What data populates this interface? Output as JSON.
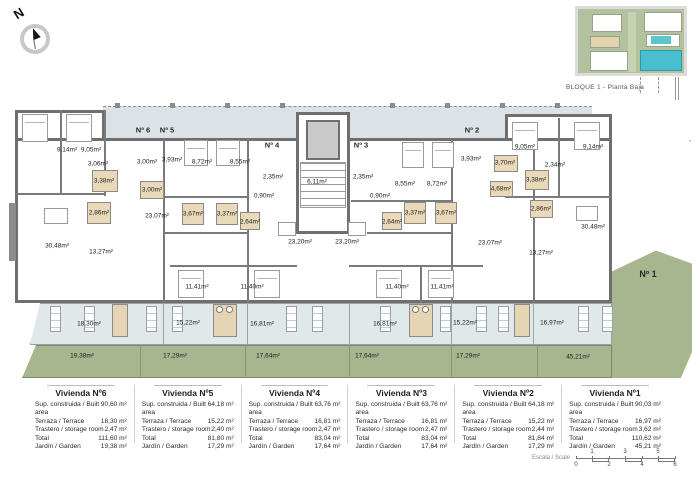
{
  "header": {
    "bloque_label": "BLOQUE 1 - Planta Baja"
  },
  "compass": {
    "letter": "N"
  },
  "plan": {
    "colors": {
      "wall": "#6f6f6f",
      "deck": "#dbe3e6",
      "terrace": "#e0e8ea",
      "garden": "#a8b690",
      "bathroom": "#ead9b8",
      "highlight_teal": "#49bece"
    },
    "entrances": {
      "n6": "Nº 6",
      "n5": "Nº 5",
      "n4": "Nº 4",
      "n3": "Nº 3",
      "n2": "Nº 2",
      "n1": "Nº 1"
    },
    "rooms": {
      "a1": "9,14m²",
      "a2": "9,05m²",
      "a3": "3,06m²",
      "a4": "3,38m²",
      "a5": "2,86m²",
      "a6": "30,48m²",
      "a7": "13,27m²",
      "b1": "3,00m²",
      "b2": "3,93m²",
      "b3": "3,00m²",
      "b4": "8,72m²",
      "b5": "8,55m²",
      "b6": "23,07m²",
      "b7": "3,67m²",
      "b8": "3,37m²",
      "b9": "11,41m²",
      "c1": "2,35m²",
      "c2": "0,90m²",
      "c3": "2,64m²",
      "c4": "23,20m²",
      "c5": "11,40m²",
      "c6": "6,11m²",
      "d1": "2,35m²",
      "d2": "0,90m²",
      "d3": "2,64m²",
      "d4": "23,20m²",
      "d5": "8,55m²",
      "d6": "8,72m²",
      "d7": "3,37m²",
      "d8": "3,67m²",
      "d9": "11,40m²",
      "e1": "3,93m²",
      "e2": "3,70m²",
      "e3": "9,05m²",
      "e4": "2,34m²",
      "e5": "3,38m²",
      "e6": "4,68m²",
      "e7": "2,86m²",
      "e8": "11,41m²",
      "e9": "23,07m²",
      "e10": "13,27m²",
      "f1": "9,14m²",
      "f2": "30,48m²",
      "t1": "18,30m²",
      "t2": "15,22m²",
      "t3": "16,81m²",
      "t4": "16,81m²",
      "t5": "15,22m²",
      "t6": "16,97m²",
      "g1": "19,38m²",
      "g2": "17,29m²",
      "g3": "17,64m²",
      "g4": "17,64m²",
      "g5": "17,29m²",
      "g6": "45,21m²"
    }
  },
  "legend_tables": {
    "row_labels": [
      "Sup. construida / Built area",
      "Terraza / Terrace",
      "Trastero / storage room",
      "Total",
      "Jardín / Garden"
    ],
    "units": [
      {
        "title": "Vivienda Nº6",
        "values": [
          "90,60 m²",
          "18,30 m²",
          "2,47 m²",
          "111,60 m²",
          "19,38 m²"
        ]
      },
      {
        "title": "Vivienda Nº5",
        "values": [
          "64,18 m²",
          "15,22 m²",
          "2,40 m²",
          "81,80 m²",
          "17,29 m²"
        ]
      },
      {
        "title": "Vivienda Nº4",
        "values": [
          "63,76 m²",
          "16,81 m²",
          "2,47 m²",
          "83,04 m²",
          "17,64 m²"
        ]
      },
      {
        "title": "Vivienda Nº3",
        "values": [
          "63,76 m²",
          "16,81 m²",
          "2,47 m²",
          "83,04 m²",
          "17,64 m²"
        ]
      },
      {
        "title": "Vivienda Nº2",
        "values": [
          "64,18 m²",
          "15,22 m²",
          "2,44 m²",
          "81,84 m²",
          "17,29 m²"
        ]
      },
      {
        "title": "Vivienda Nº1",
        "values": [
          "90,03 m²",
          "16,97 m²",
          "3,62 m²",
          "110,62 m²",
          "45,21 m²"
        ]
      }
    ]
  },
  "scalebar": {
    "label": "Escala / Scale",
    "top_ticks": [
      "1",
      "3",
      "5"
    ],
    "bottom_ticks": [
      "0",
      "2",
      "4",
      "6"
    ]
  }
}
